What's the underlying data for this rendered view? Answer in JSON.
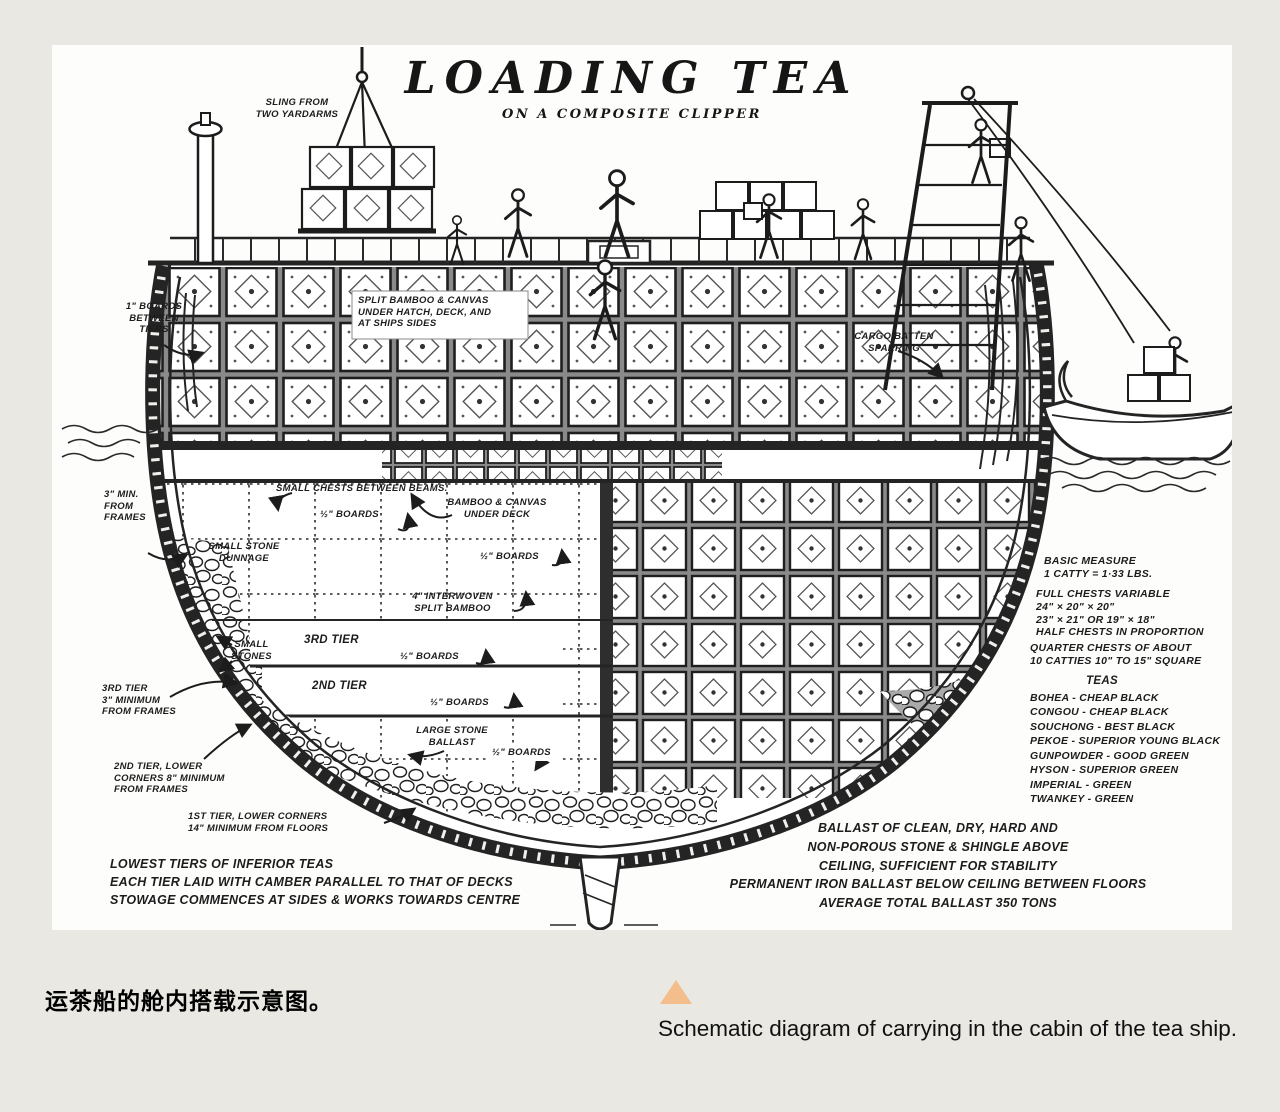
{
  "colors": {
    "page_bg": "#e9e8e2",
    "panel_bg": "#fdfdfc",
    "ink": "#1c1c1c",
    "marker_triangle": "#f3bd8c"
  },
  "diagram": {
    "title": "LOADING TEA",
    "subtitle": "ON A COMPOSITE CLIPPER",
    "annotations": {
      "sling": "SLING FROM\nTWO YARDARMS",
      "boards_between_tiers": "1\" BOARDS\nBETWEEN\nTIERS",
      "split_bamboo_hatch": "SPLIT BAMBOO & CANVAS\nUNDER HATCH, DECK, AND\nAT SHIPS SIDES",
      "cargo_batten": "CARGO BATTEN\nSPARRING",
      "min_from_frames": "3\" MIN.\nFROM\nFRAMES",
      "small_chests": "SMALL CHESTS BETWEEN BEAMS.",
      "bamboo_canvas_deck": "BAMBOO & CANVAS\nUNDER DECK",
      "half_boards_1": "½\" BOARDS",
      "small_stone_dunnage": "SMALL STONE\nDUNNAGE",
      "half_boards_2": "½\" BOARDS",
      "interwoven": "4\" INTERWOVEN\nSPLIT BAMBOO",
      "small_stones": "SMALL\nSTONES",
      "third_tier": "3RD TIER",
      "half_boards_3": "½\" BOARDS",
      "second_tier": "2ND TIER",
      "half_boards_4": "½\" BOARDS",
      "large_stone_ballast": "LARGE STONE\nBALLAST",
      "half_boards_5": "½\" BOARDS",
      "third_tier_min": "3RD TIER\n3\" MINIMUM\nFROM FRAMES",
      "second_tier_min": "2ND TIER, LOWER\nCORNERS 8\" MINIMUM\nFROM FRAMES",
      "first_tier_min": "1ST TIER, LOWER CORNERS\n14\" MINIMUM FROM FLOORS",
      "lowest_tiers": "LOWEST TIERS OF INFERIOR TEAS\nEACH TIER LAID WITH CAMBER PARALLEL TO THAT OF DECKS\nSTOWAGE COMMENCES AT SIDES & WORKS TOWARDS CENTRE",
      "basic_measure": "BASIC MEASURE\n1 CATTY = 1·33 LBS.",
      "full_chests": "FULL CHESTS VARIABLE\n24\" × 20\" × 20\"\n23\" × 21\" OR 19\" × 18\"\nHALF CHESTS IN PROPORTION",
      "quarter_chests": "QUARTER CHESTS OF ABOUT\n10 CATTIES 10\" TO 15\" SQUARE",
      "teas_title": "TEAS",
      "teas_list": "BOHEA - CHEAP BLACK\nCONGOU - CHEAP BLACK\nSOUCHONG - BEST BLACK\nPEKOE - SUPERIOR YOUNG BLACK\nGUNPOWDER - GOOD GREEN\nHYSON - SUPERIOR GREEN\nIMPERIAL - GREEN\nTWANKEY - GREEN",
      "ballast_note": "BALLAST OF CLEAN, DRY, HARD AND\nNON-POROUS STONE & SHINGLE ABOVE\nCEILING, SUFFICIENT FOR STABILITY\nPERMANENT IRON BALLAST BELOW CEILING BETWEEN FLOORS\nAVERAGE TOTAL BALLAST 350 TONS"
    }
  },
  "captions": {
    "chinese": "运茶船的舱内搭载示意图。",
    "english": "Schematic diagram of carrying in the cabin of the tea ship."
  }
}
